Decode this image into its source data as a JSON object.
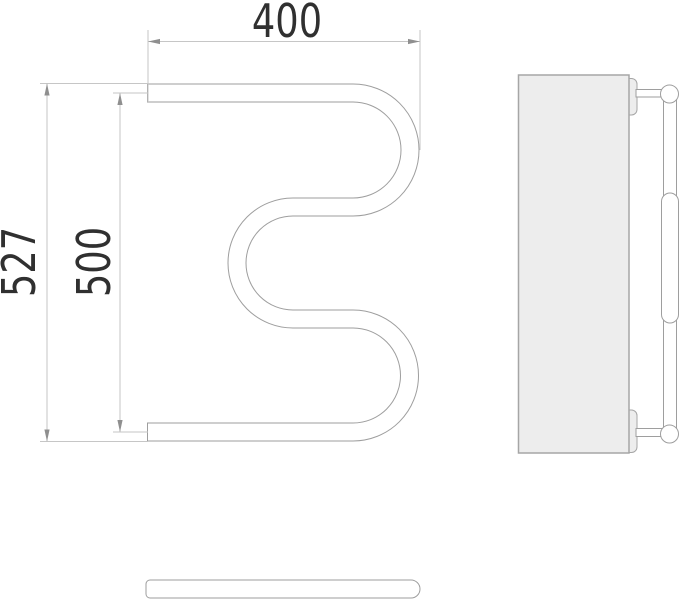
{
  "dimensions": {
    "width_mm": "400",
    "overall_height_mm": "527",
    "axis_height_mm": "500"
  },
  "colors": {
    "background": "#ffffff",
    "outline": "#9e9e9e",
    "dimension_lines": "#c6c6c6",
    "arrowheads": "#8f8f8f",
    "text": "#303030",
    "panel_fill": "#ededed"
  }
}
